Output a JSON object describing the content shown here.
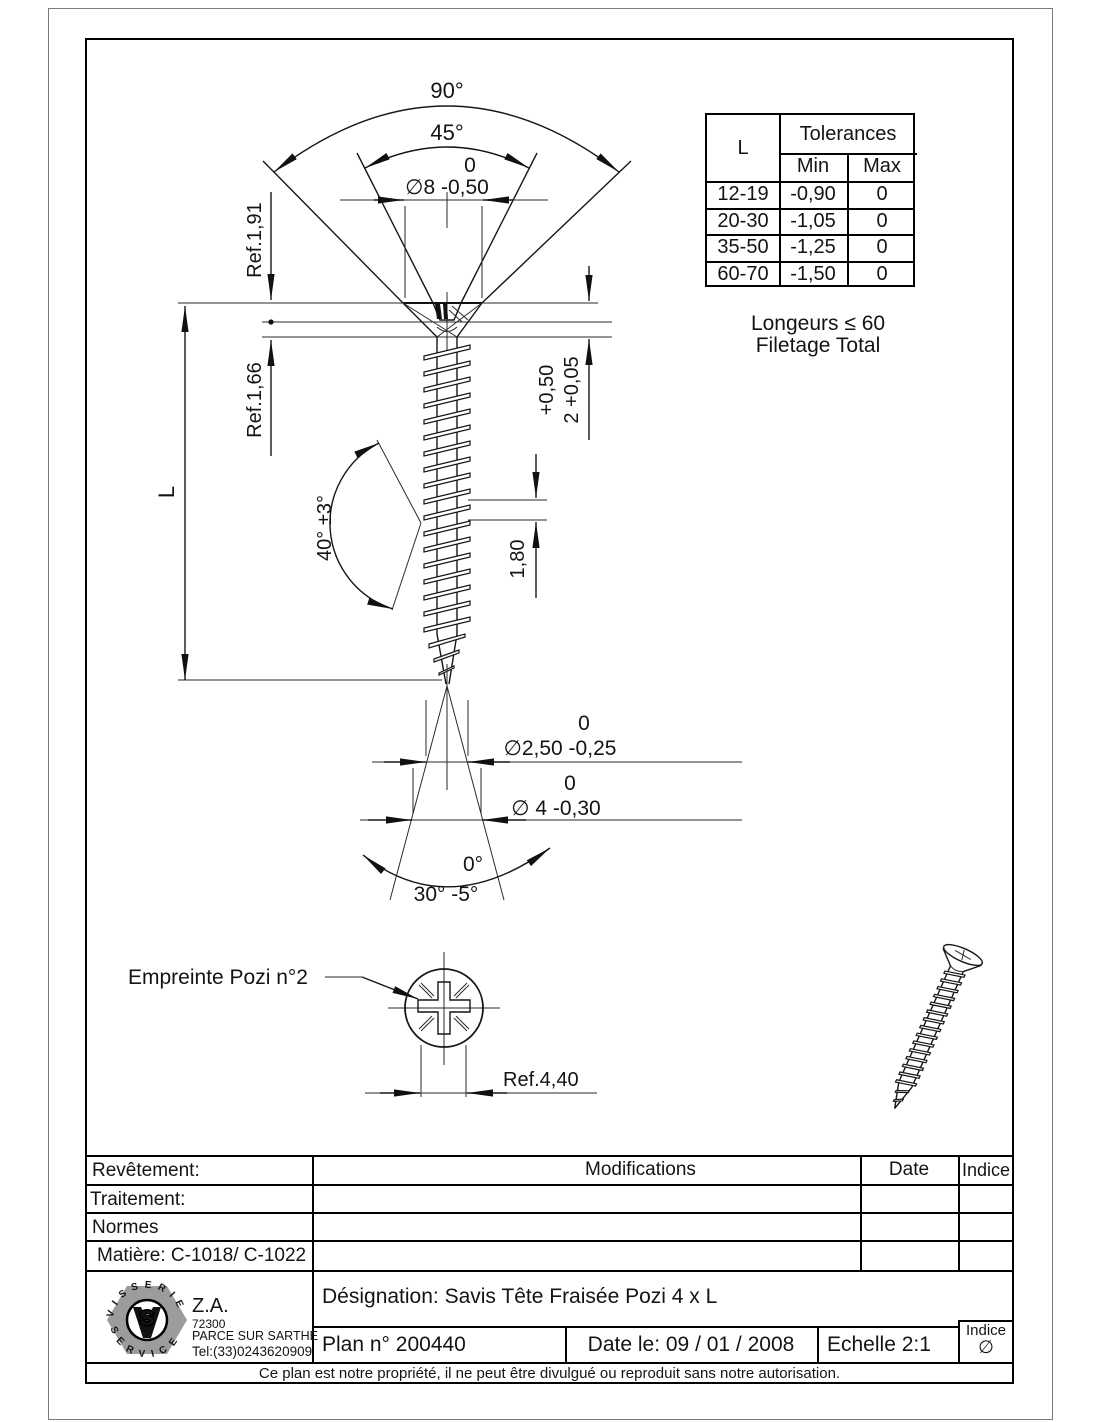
{
  "colors": {
    "line": "#141414",
    "logo_gray": "#9c9c9c"
  },
  "schematic": {
    "angle90": "90°",
    "angle45": "45°",
    "dia8_upper": "0",
    "dia8": "∅8 -0,50",
    "ref_1_91": "Ref.1,91",
    "ref_1_66": "Ref.1,66",
    "length": "L",
    "head_h_upper": "+0,50",
    "head_h": "2 +0,05",
    "pitch": "1,80",
    "thread_angle": "40° ±3°",
    "dia25_upper": "0",
    "dia25": "∅2,50 -0,25",
    "dia4_upper": "0",
    "dia4": "∅ 4 -0,30",
    "tip_upper": "0°",
    "tip_angle": "30° -5°",
    "note_line1": "Longeurs ≤ 60",
    "note_line2": "Filetage Total",
    "pozi_label": "Empreinte Pozi n°2",
    "pozi_ref": "Ref.4,40"
  },
  "tolerance_table": {
    "l_header": "L",
    "title": "Tolerances",
    "min": "Min",
    "max": "Max",
    "rows": [
      {
        "l": "12-19",
        "min": "-0,90",
        "max": "0"
      },
      {
        "l": "20-30",
        "min": "-1,05",
        "max": "0"
      },
      {
        "l": "35-50",
        "min": "-1,25",
        "max": "0"
      },
      {
        "l": "60-70",
        "min": "-1,50",
        "max": "0"
      }
    ]
  },
  "title_block": {
    "revetement": "Revêtement:",
    "traitement": "Traitement:",
    "normes": "Normes",
    "matiere": "Matière: C-1018/ C-1022",
    "modifications": "Modifications",
    "date": "Date",
    "indice": "Indice",
    "designation": "Désignation: Savis Tête Fraisée Pozi  4 x L",
    "plan_no": "Plan n° 200440",
    "date_le": "Date le: 09 / 01 / 2008",
    "echelle": "Echelle 2:1",
    "indice_cell_label": "Indice",
    "indice_cell_value": "∅",
    "footer": "Ce plan est notre propriété, il ne peut être divulgué ou reproduit sans notre autorisation."
  },
  "logo": {
    "arc_top": "VISSERIE",
    "arc_bottom": "SERVICE",
    "monogram_s": "S",
    "za": "Z.A.",
    "postal": "72300",
    "city": "PARCE SUR SARTHE",
    "tel": "Tel:(33)0243620909"
  }
}
